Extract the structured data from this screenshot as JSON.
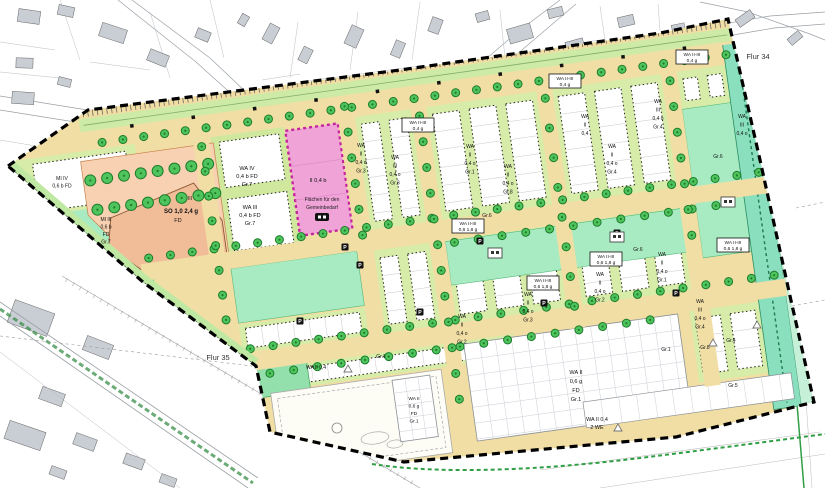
{
  "map": {
    "flur_labels": [
      "Flur 34",
      "Flur 35"
    ],
    "parking_symbol": "P",
    "zones": {
      "gemeinbedarf": {
        "use": "II 0,4 b",
        "name_line1": "Flächen für den",
        "name_line2": "Gemeinbedarf"
      },
      "so": {
        "storeys": "III",
        "value": "SO 1,0 2,4 g",
        "roof": "FD"
      },
      "wa_iv": {
        "lines": [
          "WA IV",
          "0,4 b FD",
          "Gr.7"
        ]
      },
      "wa_iii": {
        "lines": [
          "WA III",
          "0,4 b FD",
          "Gr.7"
        ]
      },
      "mi_iii": {
        "lines": [
          "MI III",
          "0,6 b",
          "FD",
          "Gr.7"
        ]
      },
      "mi_iv": {
        "lines": [
          "MI IV",
          "0,6 b FD"
        ]
      },
      "wa_ii_band": {
        "lines": [
          "WA II 0,4"
        ],
        "gr": "Gr.1"
      },
      "wa_ii_garden_large": {
        "lines": [
          "WA II",
          "0,6 g",
          "FD",
          "Gr.1"
        ]
      },
      "wa_ii_garden_small": {
        "lines": [
          "WA II",
          "0,6 g",
          "FD",
          "Gr.1"
        ]
      },
      "wa_ii_2we": {
        "lines": [
          "WA II 0,4",
          "2 WE"
        ]
      }
    },
    "strip_labels": [
      {
        "lines": [
          "WA",
          "II",
          "0,4 d",
          "Gr.3"
        ]
      },
      {
        "lines": [
          "WA",
          "III",
          "0,4 o",
          "Gr.3"
        ]
      },
      {
        "lines": [
          "WA",
          "II",
          "0,4 o",
          "Gr.1"
        ]
      },
      {
        "lines": [
          "WA",
          "II",
          "0,4 o",
          "Gr.8"
        ]
      },
      {
        "lines": [
          "WA",
          "II",
          "0,4"
        ]
      },
      {
        "lines": [
          "WA",
          "II",
          "0,4 o",
          "Gr.4"
        ]
      },
      {
        "lines": [
          "WA",
          "III",
          "0,4 o",
          "Gr.4"
        ]
      },
      {
        "lines": [
          "WA",
          "II",
          "0,4 o",
          "Gr.3"
        ]
      },
      {
        "lines": [
          "WA",
          "II",
          "0,4 o",
          "Gr.2"
        ]
      },
      {
        "lines": [
          "WA",
          "II",
          "0,4 o",
          "Gr.1"
        ]
      },
      {
        "lines": [
          "WA",
          "III",
          "0,4 o",
          "Gr.4"
        ]
      },
      {
        "lines": [
          "WA",
          "II",
          "0,4 o",
          "Gr.2"
        ]
      },
      {
        "lines": [
          "WA",
          "III",
          "0,4 o"
        ]
      }
    ],
    "boxed_labels": [
      {
        "lines": [
          "WA II-III",
          "0,4 g"
        ]
      },
      {
        "lines": [
          "WA II-III",
          "0,4 g"
        ]
      },
      {
        "lines": [
          "WA II-III",
          "0,4 g"
        ]
      },
      {
        "lines": [
          "WA II-III",
          "0,6 1,8 g"
        ]
      },
      {
        "lines": [
          "WA II-III",
          "0,6 1,8 g"
        ]
      },
      {
        "lines": [
          "WA II-III",
          "0,6 1,8 g"
        ]
      },
      {
        "lines": [
          "WA II-III",
          "0,6 1,8 g"
        ]
      }
    ],
    "gr_labels": [
      "Gr.6",
      "Gr.6",
      "Gr.6",
      "Gr.8",
      "Gr.1",
      "Gr.4",
      "Gr.5"
    ]
  },
  "colors": {
    "street": "#f1dea4",
    "median": "#cdeaa6",
    "strip": "#d7eca8",
    "plot_white": "#ffffff",
    "mint": "#a8ebc2",
    "mint_dark": "#93e0ac",
    "verge": "#bfe8a3",
    "pink": "#efa3d7",
    "pink_border": "#c4259e",
    "orange": "#f7d1b1",
    "orange_inner": "#f1bd98",
    "teal": "#89dfbe",
    "teal_light": "#c6f1d8",
    "tree": "#4fc45c",
    "tree_dark": "#1d7c2c",
    "boundary": "#000000",
    "grid_line": "#c9ced6",
    "building": "#c9cdd4",
    "cad_line": "#9aa0a6",
    "hedge_green": "#2f9e44"
  }
}
